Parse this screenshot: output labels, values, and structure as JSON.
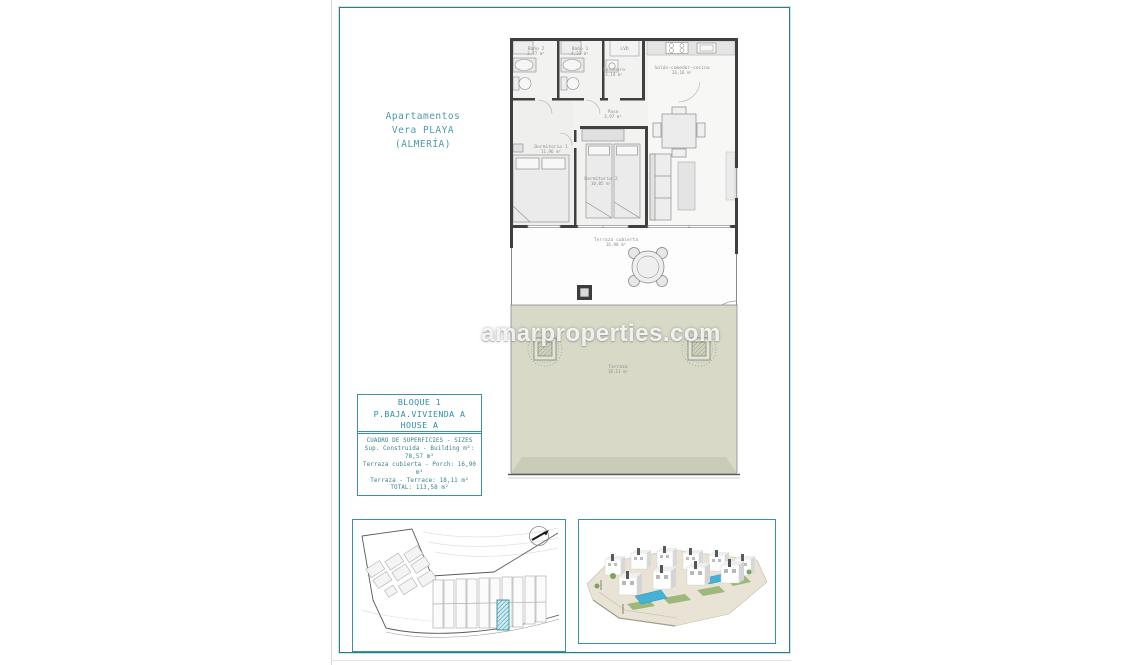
{
  "page": {
    "watermark": "amarproperties.com"
  },
  "header": {
    "title_line1": "Apartamentos",
    "title_line2": "Vera PLAYA",
    "title_line3": "(ALMERÍA)"
  },
  "unit_label": {
    "line1": "BLOQUE 1",
    "line2": "P.BAJA.VIVIENDA A",
    "line3": "HOUSE A"
  },
  "surfaces": {
    "title": "CUADRO DE SUPERFICIES - SIZES",
    "rows": [
      "Sup. Construida - Building m²: 78,57 m²",
      "Terraza cubierta - Porch: 16,90 m²",
      "Terraza - Terrace: 18,11 m²",
      "TOTAL: 113,58 m²"
    ]
  },
  "plan": {
    "rooms": {
      "bath2_name": "Baño 2",
      "bath2_area": "3,77 m²",
      "bath1_name": "Baño 1",
      "bath1_area": "4,23 m²",
      "lvd": "LVD",
      "laundry_name": "Lavadero",
      "laundry_area": "3,14 m²",
      "living_name": "Salón-comedor-cocina",
      "living_area": "26,16 m²",
      "hall_name": "Paso",
      "hall_area": "3,97 m²",
      "bed1_name": "Dormitorio 1",
      "bed1_area": "11,96 m²",
      "bed2_name": "Dormitorio 2",
      "bed2_area": "10,05 m²",
      "terrace_cov_name": "Terraza cubierta",
      "terrace_cov_area": "16,90 m²",
      "terrace_name": "Terraza",
      "terrace_area": "18,11 m²"
    }
  },
  "colors": {
    "accent_teal": "#3a93a5",
    "title_teal": "#4e9aa8",
    "wall_dark": "#404040",
    "terrace_green": "#d8dac7"
  }
}
